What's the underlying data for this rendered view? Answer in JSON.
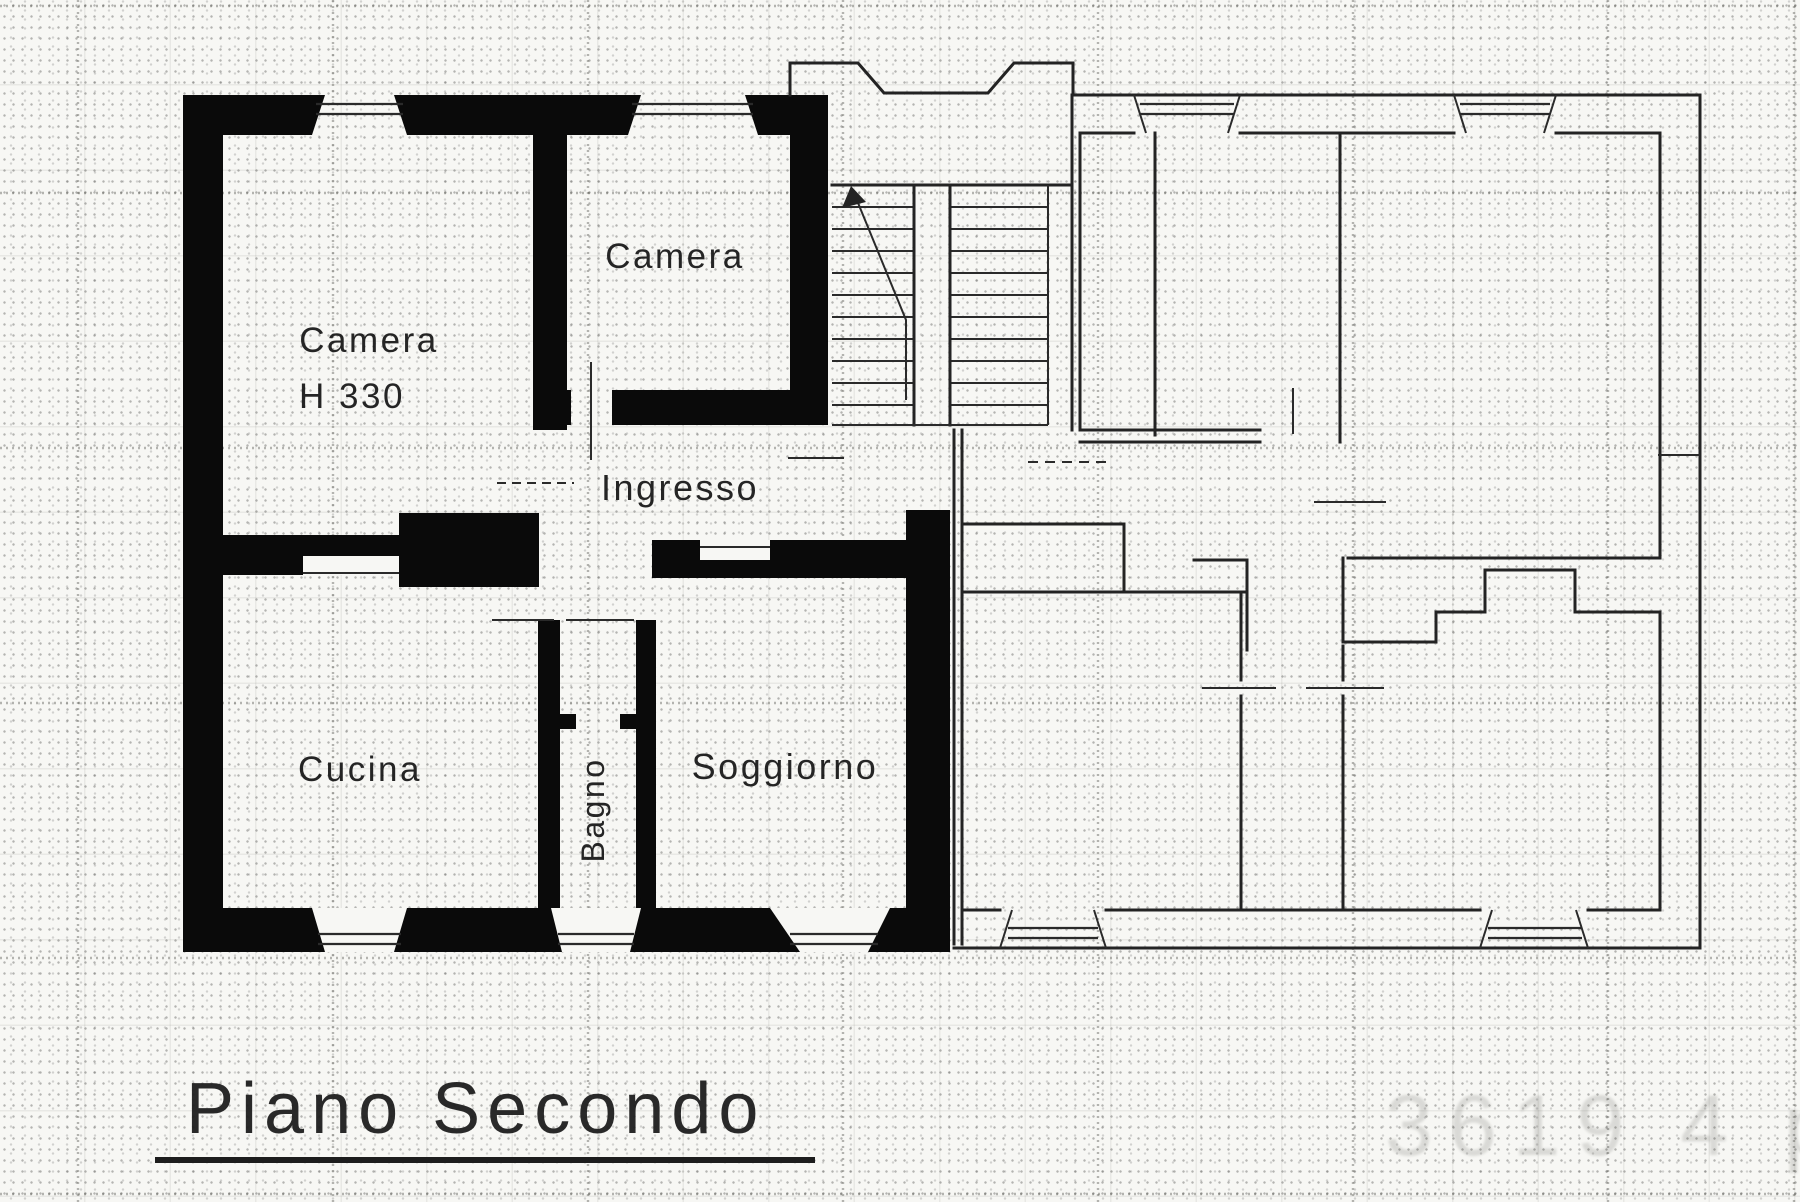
{
  "document": {
    "kind": "scanned cadastral floor plan",
    "floor_title": "Piano Secondo",
    "stamp_number": "3619 4 p"
  },
  "rooms": {
    "camera_grande": {
      "label": "Camera",
      "height_note": "H 330"
    },
    "camera_piccola": {
      "label": "Camera"
    },
    "ingresso": {
      "label": "Ingresso"
    },
    "cucina": {
      "label": "Cucina"
    },
    "bagno": {
      "label": "Bagno"
    },
    "soggiorno": {
      "label": "Soggiorno"
    }
  },
  "colors": {
    "paper": "#f7f7f4",
    "wall": "#0a0a0a",
    "thin_line": "#232323",
    "grid": "#55554e"
  }
}
